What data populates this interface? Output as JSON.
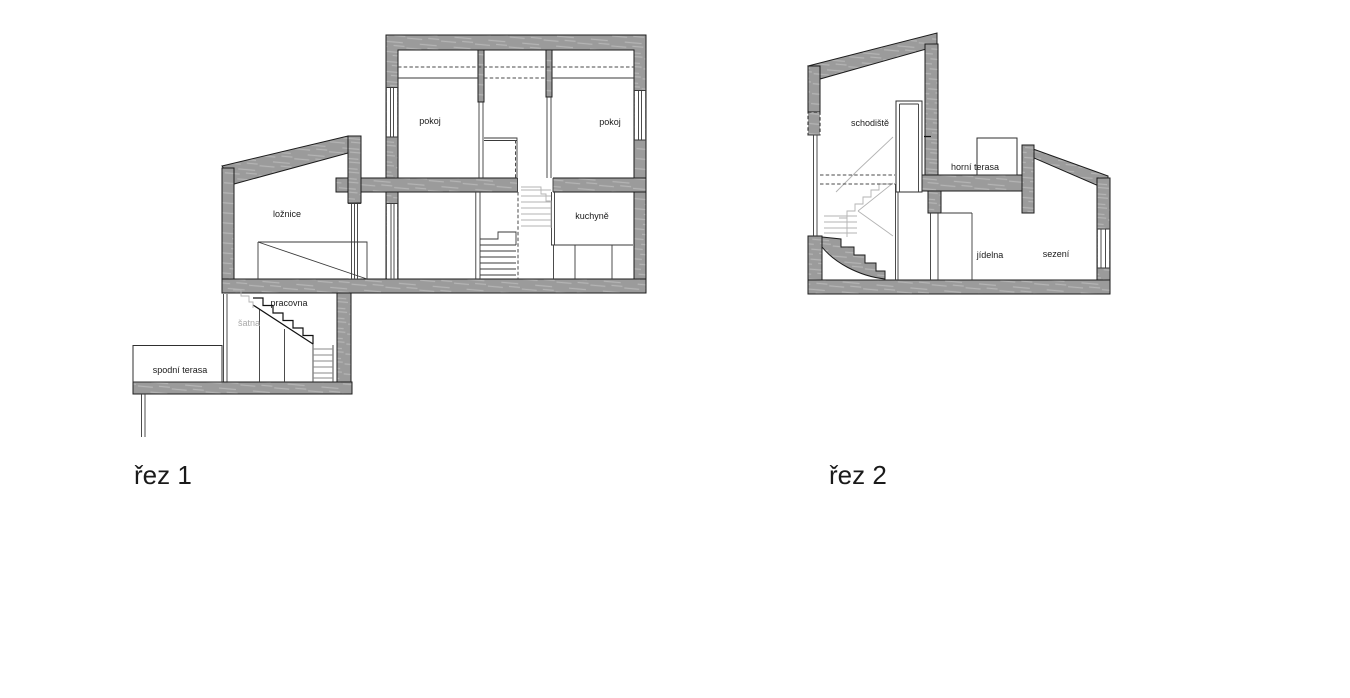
{
  "colors": {
    "wall": "#9b9b9b",
    "wall_streak": "#b4b4b4",
    "outline": "#1c1c1c",
    "thin_line": "#3a3a3a",
    "hidden_gray": "#b3b3b3",
    "label": "#1a1a1a",
    "label_muted": "#a9a9a9",
    "background": "#ffffff"
  },
  "sections": [
    {
      "title": "řez 1",
      "rooms": [
        {
          "label": "pokoj"
        },
        {
          "label": "pokoj"
        },
        {
          "label": "ložnice"
        },
        {
          "label": "kuchyně"
        },
        {
          "label": "pracovna"
        },
        {
          "label": "šatna"
        },
        {
          "label": "spodní terasa"
        }
      ]
    },
    {
      "title": "řez 2",
      "rooms": [
        {
          "label": "schodiště"
        },
        {
          "label": "horní terasa"
        },
        {
          "label": "jídelna"
        },
        {
          "label": "sezení"
        }
      ]
    }
  ]
}
